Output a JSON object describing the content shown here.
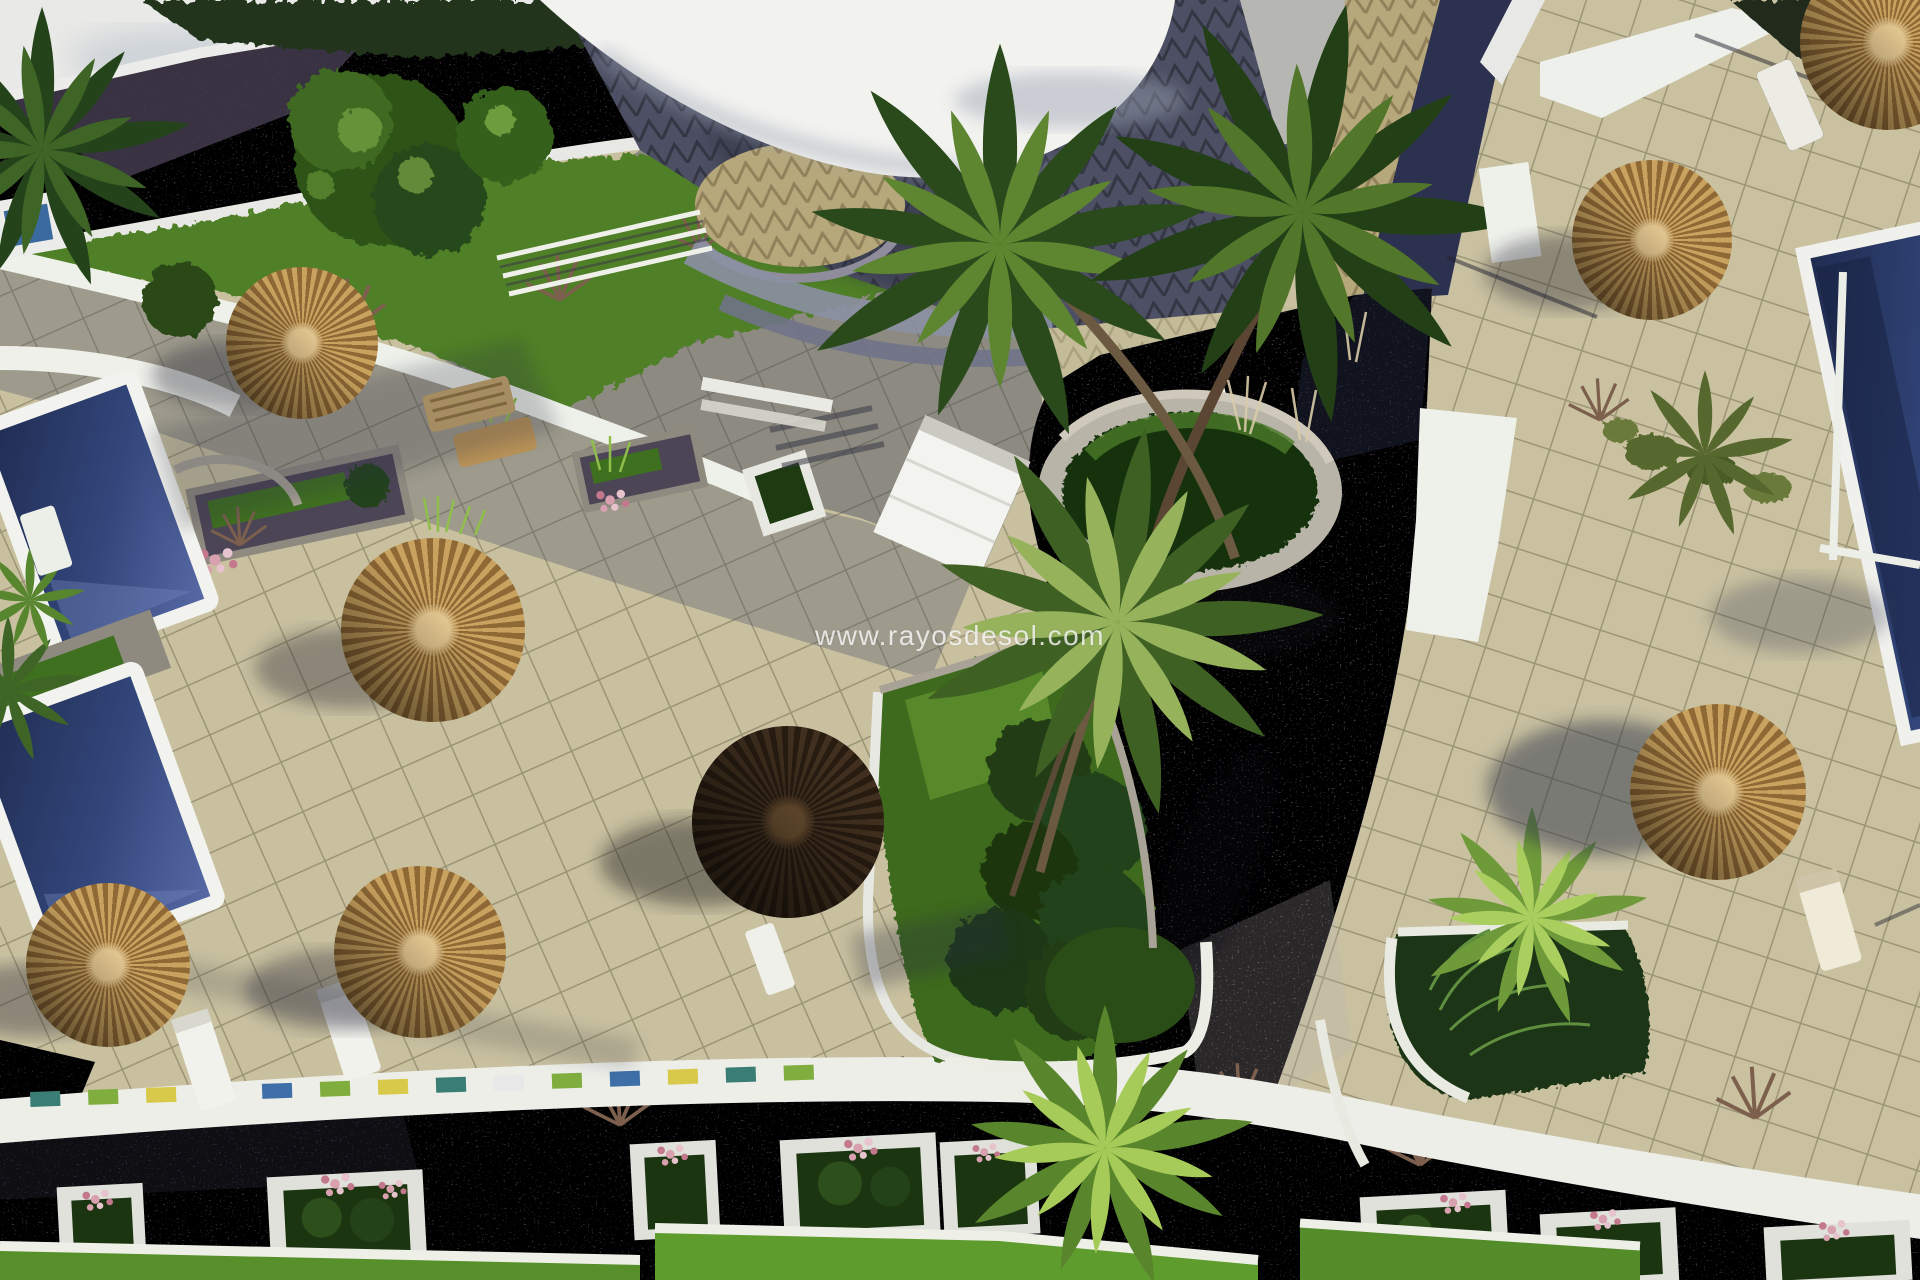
{
  "meta": {
    "type": "3d-architectural-render",
    "view": "aerial",
    "subject": "Mediterranean resort courtyard with swimming pools, thatch parasols, sun loungers, palm trees, tiled terraces and cobbled paths"
  },
  "watermark": {
    "text": "www.rayosdesol.com"
  },
  "palette": {
    "terrace": "#c8c09f",
    "terrace_shadow": "#6a6f85",
    "slate_roof": "#4d5064",
    "chevron_beige": "#b7a87c",
    "cobble": "#6e6678",
    "cobble_dark": "#3a3f53",
    "pool_deep": "#1f2a4e",
    "pool_light": "#5a6ca8",
    "white_walkway": "#f2f2ee",
    "lawn": "#57902a",
    "lawn_dark": "#2a4d17",
    "foliage_dark": "#24421a",
    "foliage_light": "#96b35c",
    "straw_light": "#c9a25f",
    "straw_dark": "#8e6835",
    "umbrella_brown_1": "#41301f",
    "umbrella_brown_2": "#281c11",
    "flower_pink": "#d9a0b0",
    "mosaic_teal": "#3a7d74",
    "mosaic_green": "#7fae3f",
    "mosaic_yellow": "#d8c94a",
    "mosaic_blue": "#3f6fa8"
  },
  "inventory": {
    "thatch_parasols": 8,
    "swimming_pools": 3,
    "sun_loungers": 7,
    "flower_planters": 8
  }
}
